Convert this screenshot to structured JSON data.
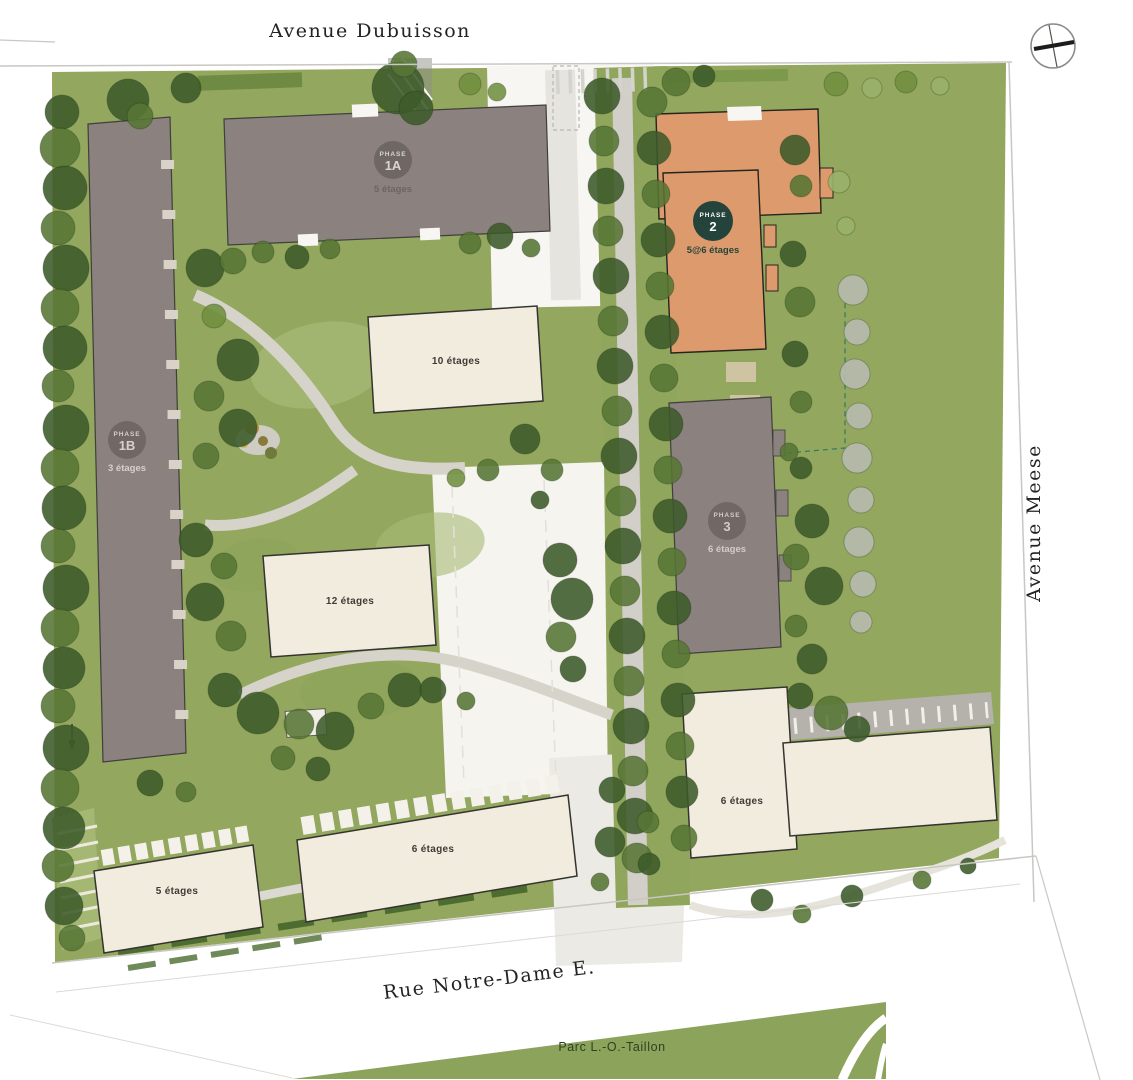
{
  "plan": {
    "streets": {
      "top": "Avenue Dubuisson",
      "right": "Avenue Meese",
      "bottom": "Rue Notre-Dame E.",
      "park": "Parc L.-O.-Taillon"
    },
    "phases": [
      {
        "name": "PHASE",
        "number": "1A",
        "floors": "5 étages"
      },
      {
        "name": "PHASE",
        "number": "1B",
        "floors": "3 étages"
      },
      {
        "name": "PHASE",
        "number": "2",
        "floors": "5@6 étages"
      },
      {
        "name": "PHASE",
        "number": "3",
        "floors": "6 étages"
      }
    ],
    "buildings": [
      {
        "label": "10 étages"
      },
      {
        "label": "12 étages"
      },
      {
        "label": "6 étages"
      },
      {
        "label": "6 étages"
      },
      {
        "label": "5 étages"
      }
    ],
    "icons": {
      "north": "north-arrow"
    },
    "colors": {
      "site_green": "#93a75f",
      "lawn_light": "#a7ba75",
      "tree_dark": "#3c5a2a",
      "tree_mid": "#567534",
      "tree_light": "#6f8f3f",
      "tree_sage": "#9ab26b",
      "tree_gray": "#b7bbb2",
      "building_gray": "#8b817e",
      "building_orange": "#dd9b6d",
      "building_beige": "#f2ecdf",
      "badge_green": "#24433a",
      "badge_gray": "#6b6360",
      "park_olive": "#8ba35b",
      "path_gray": "#d4d1c9"
    }
  }
}
